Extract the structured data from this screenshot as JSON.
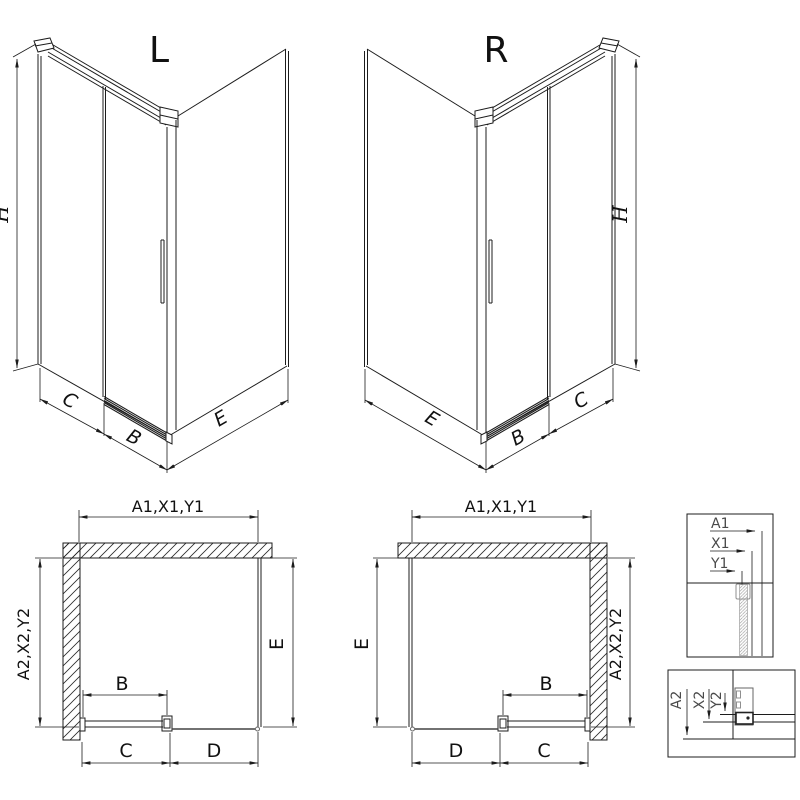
{
  "views": {
    "iso_left": {
      "title": "L",
      "dims": {
        "height": "H",
        "wall_c": "C",
        "door_b": "B",
        "side_e": "E"
      }
    },
    "iso_right": {
      "title": "R",
      "dims": {
        "height": "H",
        "wall_c": "C",
        "door_b": "B",
        "side_e": "E"
      }
    },
    "plan_left": {
      "dims": {
        "width_top": "A1,X1,Y1",
        "depth_side": "A2,X2,Y2",
        "depth_e": "E",
        "door_b": "B",
        "seg_c": "C",
        "seg_d": "D"
      }
    },
    "plan_right": {
      "dims": {
        "width_top": "A1,X1,Y1",
        "depth_side": "A2,X2,Y2",
        "depth_e": "E",
        "door_b": "B",
        "seg_c": "C",
        "seg_d": "D"
      }
    },
    "detail_width_section": {
      "rows": [
        "A1",
        "X1",
        "Y1"
      ]
    },
    "detail_height_section": {
      "rows": [
        "A2",
        "X2",
        "Y2"
      ]
    }
  },
  "colors": {
    "line": "#1c1c1c",
    "detail_gray": "#8f8f8f",
    "rail_gray": "#444444",
    "background": "#ffffff"
  }
}
